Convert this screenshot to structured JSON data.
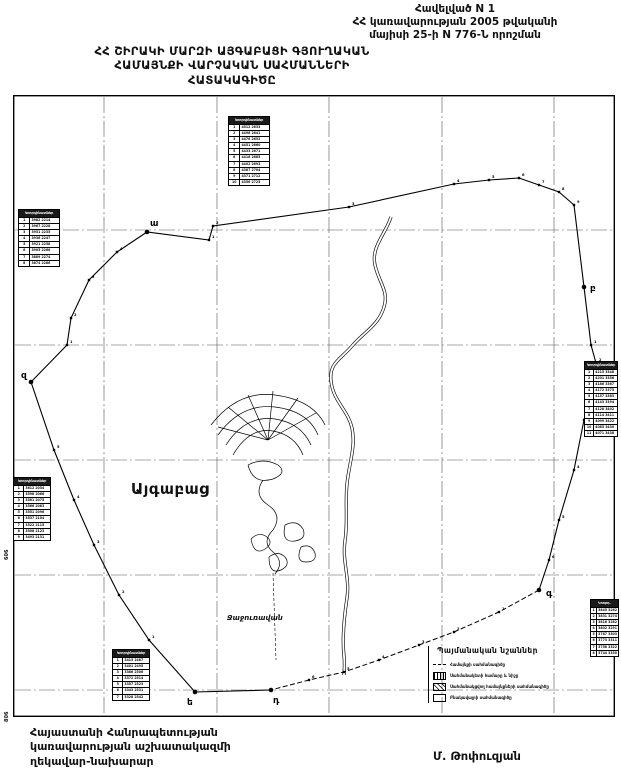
{
  "header": {
    "line1": "Հավելված N 1",
    "line2": "ՀՀ կառավարության 2005 թվականի",
    "line3": "մայիսի 25-ի N 776-Ն որոշման"
  },
  "title": {
    "line1": "ՀՀ ՇԻՐԱԿԻ ՄԱՐԶԻ ԱՅԳԱԲԱՑԻ ԳՅՈՒՂԱԿԱՆ",
    "line2": "ՀԱՄԱՅՆՔԻ  ՎԱՐՉԱԿԱՆ ՍԱՀՄԱՆՆԵՐԻ",
    "line3": "ՀԱՏԱԿԱԳԻԾԸ"
  },
  "map": {
    "community_label": "Այգաբաց",
    "neighbor_label": "Ջաջուռավան",
    "grid_label_left": "606",
    "grid_label_corner": "806",
    "boundary": {
      "points": [
        [
          134,
          137,
          "ա",
          3,
          -6
        ],
        [
          196,
          145,
          ""
        ],
        [
          200,
          131,
          ""
        ],
        [
          336,
          112,
          ""
        ],
        [
          441,
          89,
          ""
        ],
        [
          476,
          85,
          ""
        ],
        [
          506,
          83,
          ""
        ],
        [
          526,
          90,
          ""
        ],
        [
          546,
          97,
          ""
        ],
        [
          561,
          110,
          ""
        ],
        [
          571,
          192,
          "բ",
          6,
          4
        ],
        [
          578,
          250,
          ""
        ],
        [
          583,
          268,
          ""
        ],
        [
          571,
          325,
          ""
        ],
        [
          561,
          375,
          ""
        ],
        [
          546,
          425,
          ""
        ],
        [
          536,
          465,
          ""
        ],
        [
          526,
          495,
          "գ",
          7,
          6
        ],
        [
          486,
          517,
          ""
        ],
        [
          441,
          537,
          ""
        ],
        [
          406,
          550,
          ""
        ],
        [
          366,
          565,
          ""
        ],
        [
          331,
          577,
          ""
        ],
        [
          296,
          585,
          ""
        ],
        [
          258,
          595,
          "դ",
          2,
          13
        ],
        [
          182,
          597,
          "ե",
          -8,
          13
        ],
        [
          136,
          545,
          ""
        ],
        [
          106,
          500,
          ""
        ],
        [
          81,
          450,
          ""
        ],
        [
          61,
          405,
          ""
        ],
        [
          41,
          355,
          ""
        ],
        [
          18,
          287,
          "զ",
          -10,
          -4
        ],
        [
          54,
          250,
          ""
        ],
        [
          58,
          223,
          ""
        ],
        [
          76,
          185,
          ""
        ],
        [
          104,
          157,
          ""
        ]
      ]
    }
  },
  "legend": {
    "title": "Պայմանական նշաններ",
    "items": [
      {
        "symbol": "sym-boundary-line",
        "label": "Համայնքի սահմանագիծը"
      },
      {
        "symbol": "sym-boundary-point",
        "label": "Սահմանակետի համարը և նիշը"
      },
      {
        "symbol": "sym-adjacent-area",
        "label": "Սահմանակցվող համայնքների սահմանագիծը"
      },
      {
        "symbol": "sym-settlement-outline",
        "label": "Բնակավայրի սահմանագիծը"
      }
    ]
  },
  "tables": [
    {
      "x": 228,
      "y": 116,
      "w": 42,
      "title": "Կոորդինատներ",
      "rows": [
        [
          "1",
          "4512 2633"
        ],
        [
          "2",
          "4498 2641"
        ],
        [
          "3",
          "4476 2652"
        ],
        [
          "4",
          "4451 2660"
        ],
        [
          "5",
          "4433 2671"
        ],
        [
          "6",
          "4418 2685"
        ],
        [
          "7",
          "4402 2693"
        ],
        [
          "8",
          "4387 2704"
        ],
        [
          "9",
          "4371 2712"
        ],
        [
          "10",
          "4356 2725"
        ]
      ]
    },
    {
      "x": 18,
      "y": 209,
      "w": 42,
      "title": "Կոորդինատներ",
      "rows": [
        [
          "1",
          "3982 2214"
        ],
        [
          "2",
          "3967 2228"
        ],
        [
          "3",
          "3951 2235"
        ],
        [
          "4",
          "3936 2247"
        ],
        [
          "5",
          "3921 2258"
        ],
        [
          "6",
          "3905 2266"
        ],
        [
          "7",
          "3889 2274"
        ],
        [
          "8",
          "3874 2286"
        ]
      ]
    },
    {
      "x": 13,
      "y": 477,
      "w": 38,
      "title": "Կոորդինատներ",
      "rows": [
        [
          "1",
          "3612 2054"
        ],
        [
          "2",
          "3598 2066"
        ],
        [
          "3",
          "3581 2075"
        ],
        [
          "4",
          "3566 2083"
        ],
        [
          "5",
          "3551 2096"
        ],
        [
          "6",
          "3537 2104"
        ],
        [
          "7",
          "3522 2115"
        ],
        [
          "8",
          "3508 2123"
        ],
        [
          "9",
          "3493 2131"
        ]
      ]
    },
    {
      "x": 584,
      "y": 361,
      "w": 34,
      "title": "Կոորդինատներ",
      "rows": [
        [
          "1",
          "4215 3348"
        ],
        [
          "2",
          "4201 3356"
        ],
        [
          "3",
          "4186 3367"
        ],
        [
          "4",
          "4172 3375"
        ],
        [
          "5",
          "4157 3383"
        ],
        [
          "6",
          "4143 3394"
        ],
        [
          "7",
          "4128 3402"
        ],
        [
          "8",
          "4114 3411"
        ],
        [
          "9",
          "4099 3422"
        ],
        [
          "10",
          "4085 3430"
        ],
        [
          "11",
          "4071 3438"
        ]
      ]
    },
    {
      "x": 590,
      "y": 599,
      "w": 29,
      "title": "Կոորդ.",
      "rows": [
        [
          "1",
          "3845 3262"
        ],
        [
          "2",
          "3831 3274"
        ],
        [
          "3",
          "3816 3282"
        ],
        [
          "4",
          "3802 3291"
        ],
        [
          "5",
          "3787 3303"
        ],
        [
          "6",
          "3773 3311"
        ],
        [
          "7",
          "3758 3322"
        ],
        [
          "8",
          "3744 3330"
        ]
      ]
    },
    {
      "x": 112,
      "y": 649,
      "w": 38,
      "title": "Կոորդինատներ",
      "rows": [
        [
          "1",
          "3415 2487"
        ],
        [
          "2",
          "3401 2495"
        ],
        [
          "3",
          "3386 2506"
        ],
        [
          "4",
          "3372 2514"
        ],
        [
          "5",
          "3357 2523"
        ],
        [
          "6",
          "3343 2531"
        ],
        [
          "7",
          "3328 2542"
        ]
      ]
    }
  ],
  "footer": {
    "left_line1": "Հայաստանի Հանրապետության",
    "left_line2": "կառավարության աշխատակազմի",
    "left_line3": "ղեկավար-նախարար",
    "signature": "Մ. Թոփուզյան"
  }
}
